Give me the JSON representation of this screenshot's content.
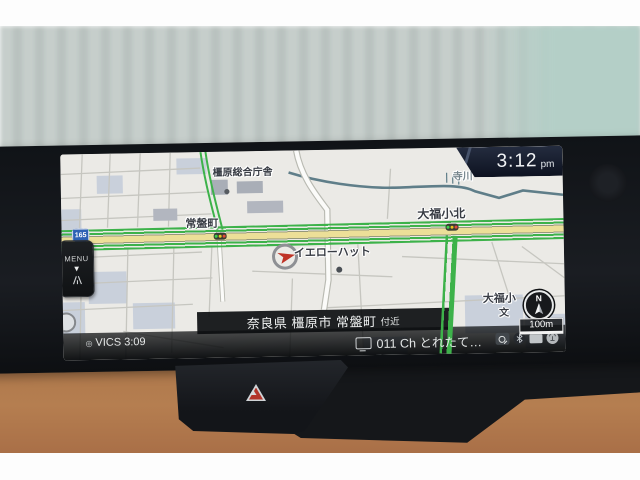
{
  "device": {
    "type": "in-car navigation display"
  },
  "clock": {
    "time": "3:12",
    "meridiem": "pm"
  },
  "menu": {
    "label": "MENU",
    "arrow": "▼"
  },
  "map": {
    "labels": {
      "government_office": "橿原総合庁舎",
      "tokiwacho": "常盤町",
      "daifuku_kita": "大福小北",
      "yellow_hat": "イエローハット",
      "terakawa": "寺川",
      "daifuku_elem": "大福小",
      "school_symbol": "文"
    },
    "route_badge": "165",
    "compass": "N",
    "scale": "100m"
  },
  "address_bar": {
    "area": "奈良県 橿原市 常盤町",
    "suffix": "付近"
  },
  "status": {
    "vics_mark": "◎",
    "vics": "VICS",
    "vics_time": "3:09",
    "tv_text": "011 Ch とれたて…"
  },
  "colors": {
    "traffic_green": "#3db24a",
    "road_fill": "#ecdf98",
    "map_bg": "#ebeae6",
    "badge_blue": "#2e62b5",
    "leather": "#ad744a"
  }
}
